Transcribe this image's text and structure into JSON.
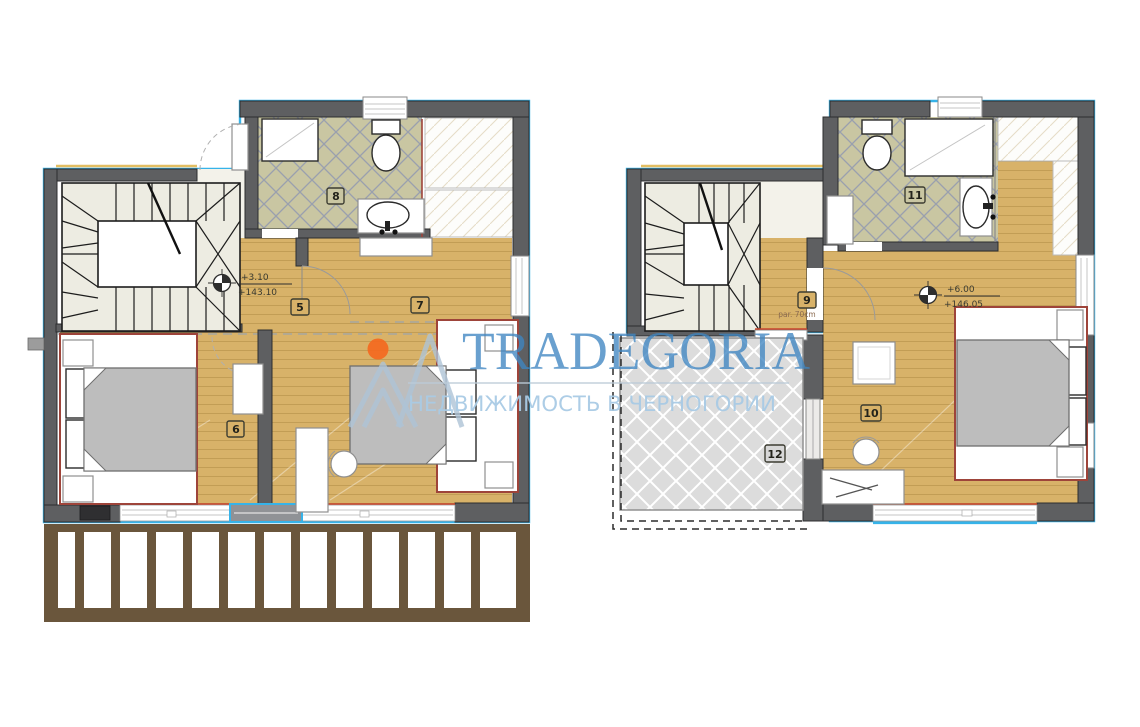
{
  "watermark": {
    "brand": "TRADEGORIA",
    "tagline": "НЕДВИЖИМОСТЬ В ЧЕРНОГОРИИ"
  },
  "plan_left": {
    "elevation": {
      "relative": "+3.10",
      "absolute": "+143.10"
    },
    "rooms": {
      "hall": "5",
      "bedroom_left": "6",
      "bedroom_right": "7",
      "bathroom": "8"
    }
  },
  "plan_right": {
    "elevation": {
      "relative": "+6.00",
      "absolute": "+146.05"
    },
    "parapet_note": "par. 70cm",
    "rooms": {
      "hall": "9",
      "bedroom": "10",
      "bathroom": "11",
      "terrace": "12"
    }
  },
  "colors": {
    "wood_floor": "#d8b269",
    "bathroom_tile": "#c9c6a2",
    "tile_grid": "#9aa0ae",
    "wall_gray": "#5e5f61",
    "outline_cyan": "#36b3e9",
    "accent_maroon": "#9e443a",
    "window_red_line": "#c8452c",
    "stair_fill": "#edece2",
    "terrace_fill": "#dcdcdc",
    "balcony_brown": "#6a563c",
    "mattress_gray": "#bdbdbd",
    "watermark_blue": "#3f86c2",
    "watermark_light_blue": "#a9cbe5",
    "logo_orange": "#f4691f"
  }
}
